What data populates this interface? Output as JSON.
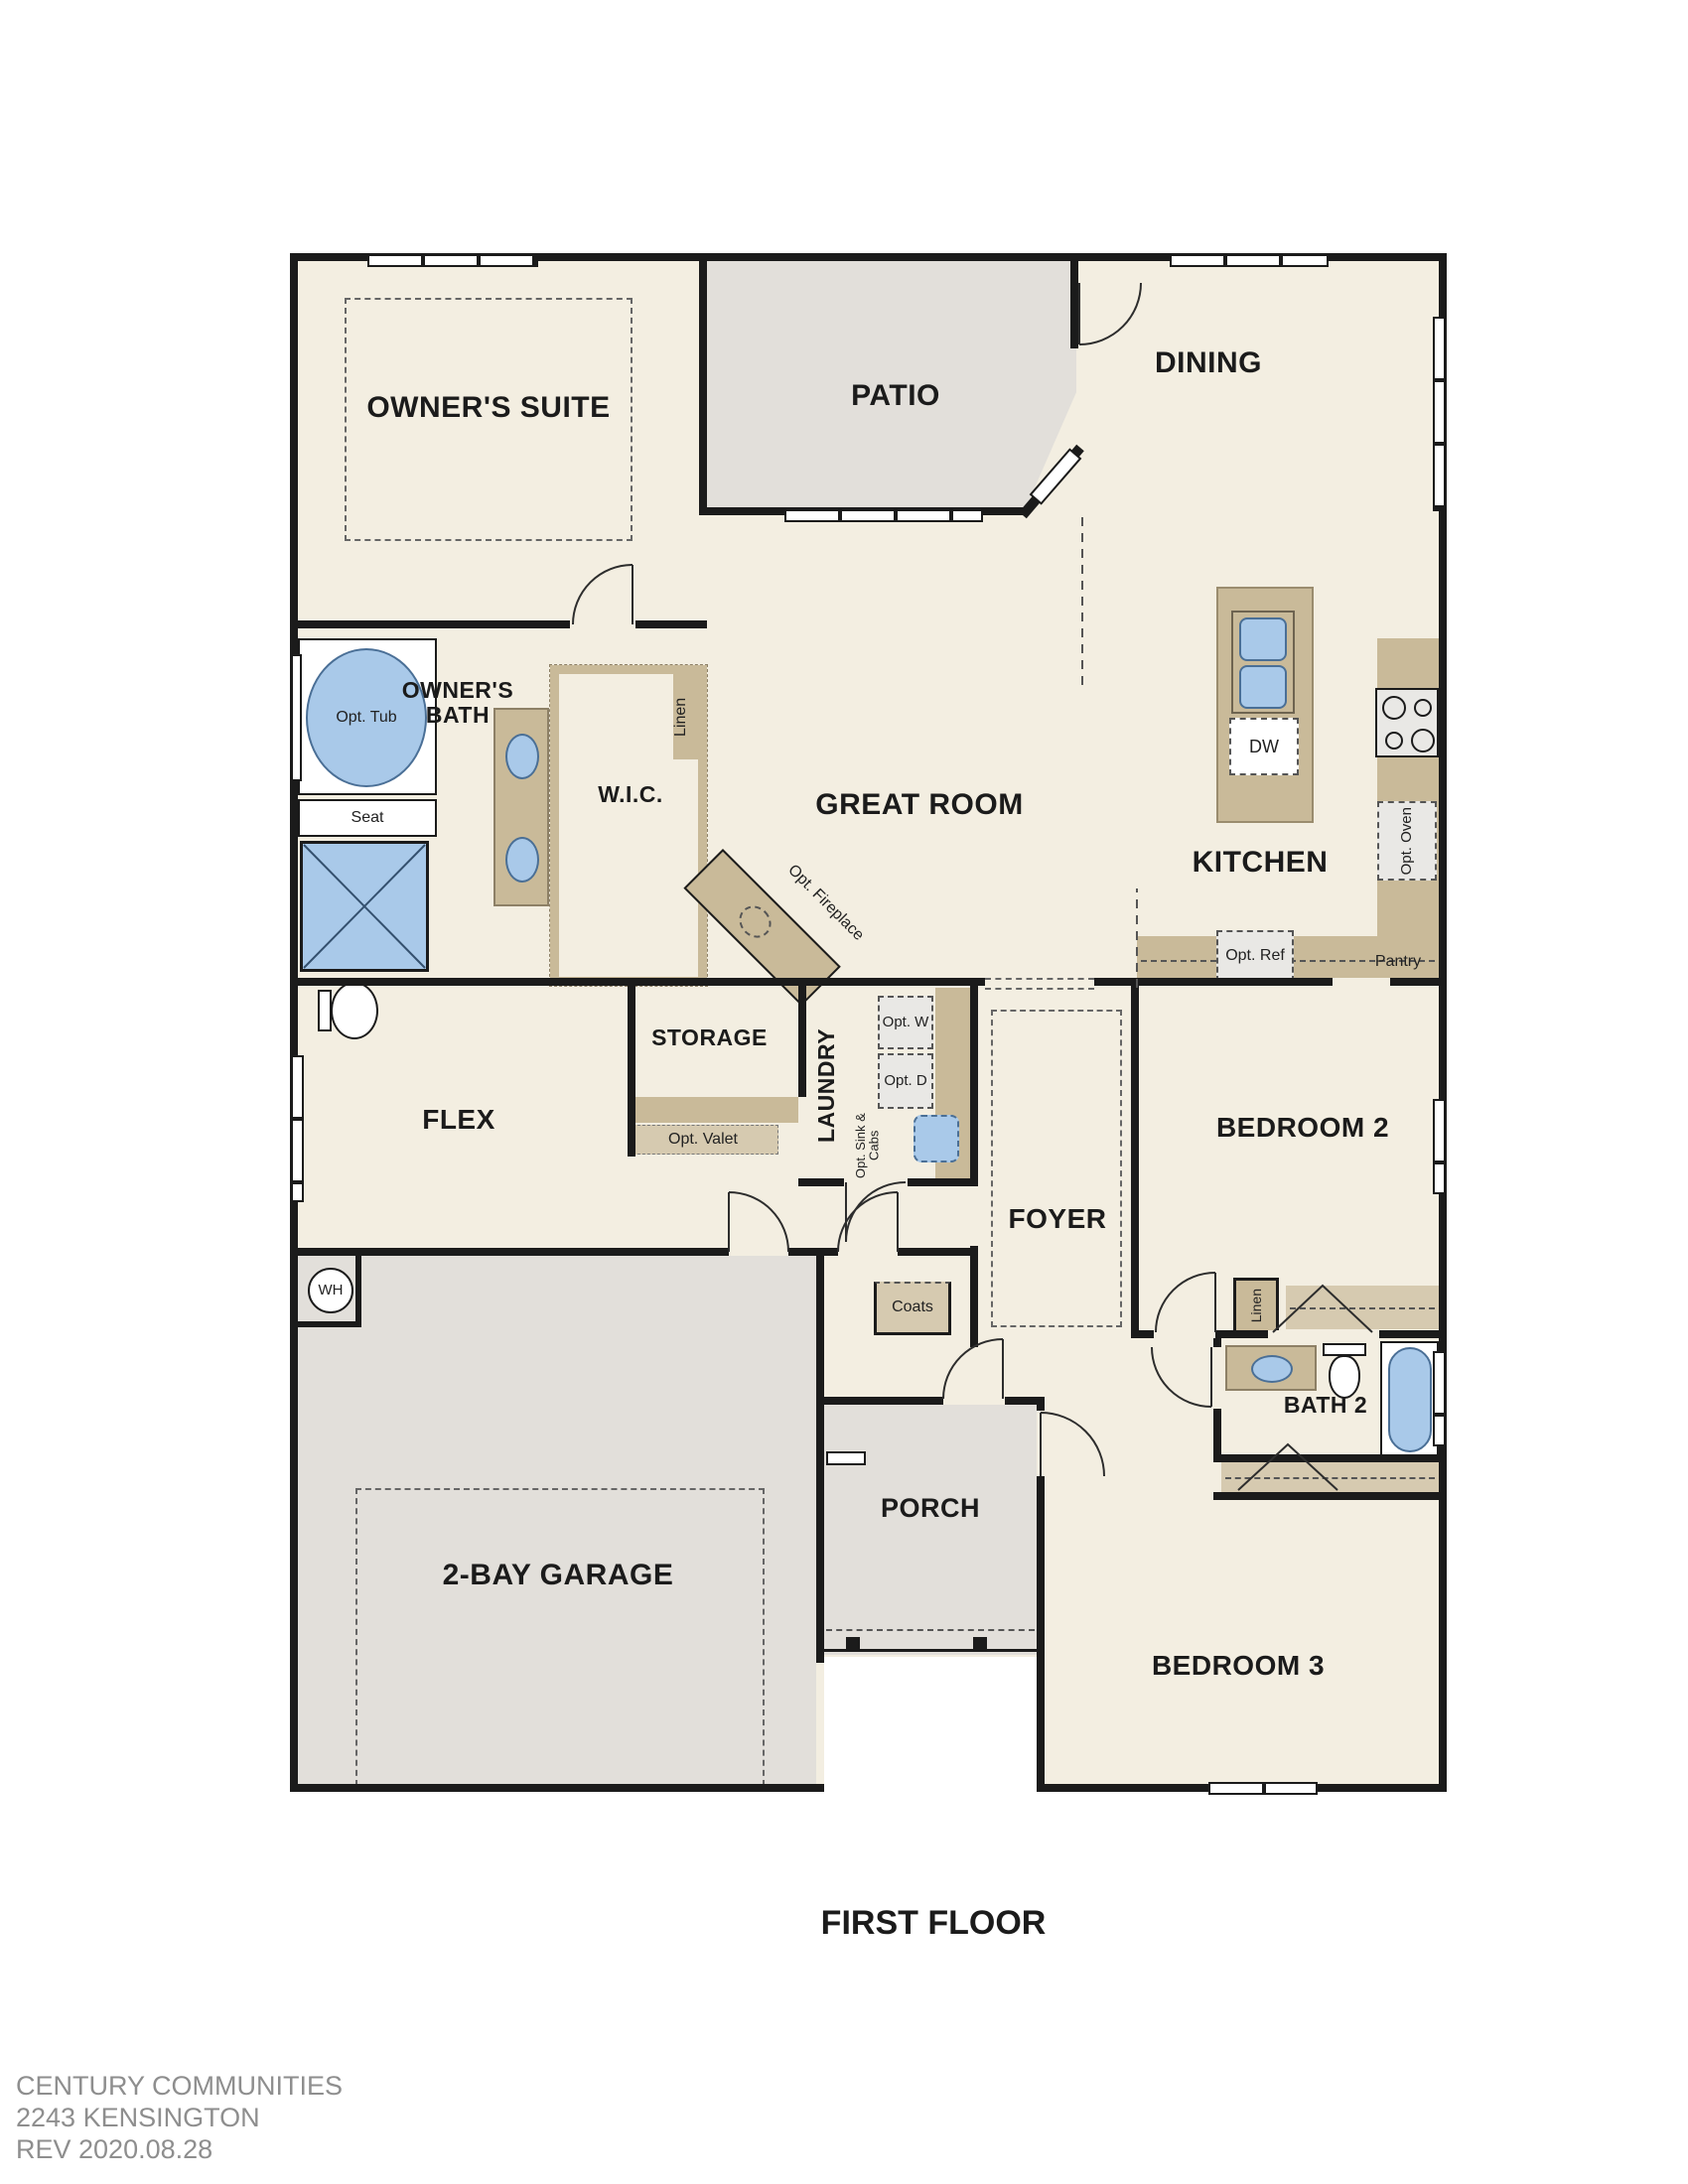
{
  "document": {
    "title": "FIRST FLOOR",
    "footer": [
      "CENTURY COMMUNITIES",
      "2243 KENSINGTON",
      "REV 2020.08.28"
    ]
  },
  "rooms": {
    "owners_suite": {
      "label": "OWNER'S SUITE"
    },
    "patio": {
      "label": "PATIO"
    },
    "dining": {
      "label": "DINING"
    },
    "great_room": {
      "label": "GREAT ROOM"
    },
    "kitchen": {
      "label": "KITCHEN"
    },
    "owners_bath": {
      "label": "OWNER'S BATH"
    },
    "wic": {
      "label": "W.I.C."
    },
    "flex": {
      "label": "FLEX"
    },
    "storage": {
      "label": "STORAGE"
    },
    "laundry": {
      "label": "LAUNDRY"
    },
    "foyer": {
      "label": "FOYER"
    },
    "bedroom_2": {
      "label": "BEDROOM 2"
    },
    "bath_2": {
      "label": "BATH 2"
    },
    "porch": {
      "label": "PORCH"
    },
    "garage": {
      "label": "2-BAY GARAGE"
    },
    "bedroom_3": {
      "label": "BEDROOM 3"
    }
  },
  "fixtures": {
    "opt_tub": "Opt. Tub",
    "seat": "Seat",
    "wic_linen": "Linen",
    "hall_linen": "Linen",
    "opt_fireplace": "Opt. Fireplace",
    "dw": "DW",
    "opt_oven": "Opt. Oven",
    "opt_ref": "Opt. Ref",
    "pantry": "Pantry",
    "opt_w": "Opt. W",
    "opt_d": "Opt. D",
    "opt_sink_cabs": "Opt. Sink & Cabs",
    "opt_valet": "Opt. Valet",
    "coats": "Coats",
    "wh": "WH"
  },
  "colors": {
    "wall": "#1b1b1b",
    "interior_floor": "#f3eee1",
    "outdoor_floor": "#e2dfda",
    "cabinet_tan": "#c9ba99",
    "cabinet_light_tan": "#d6cab0",
    "fixture_blue": "#a9c9e9",
    "appliance_gray": "#e9e8e5",
    "footer_gray": "#8e8e8e"
  }
}
